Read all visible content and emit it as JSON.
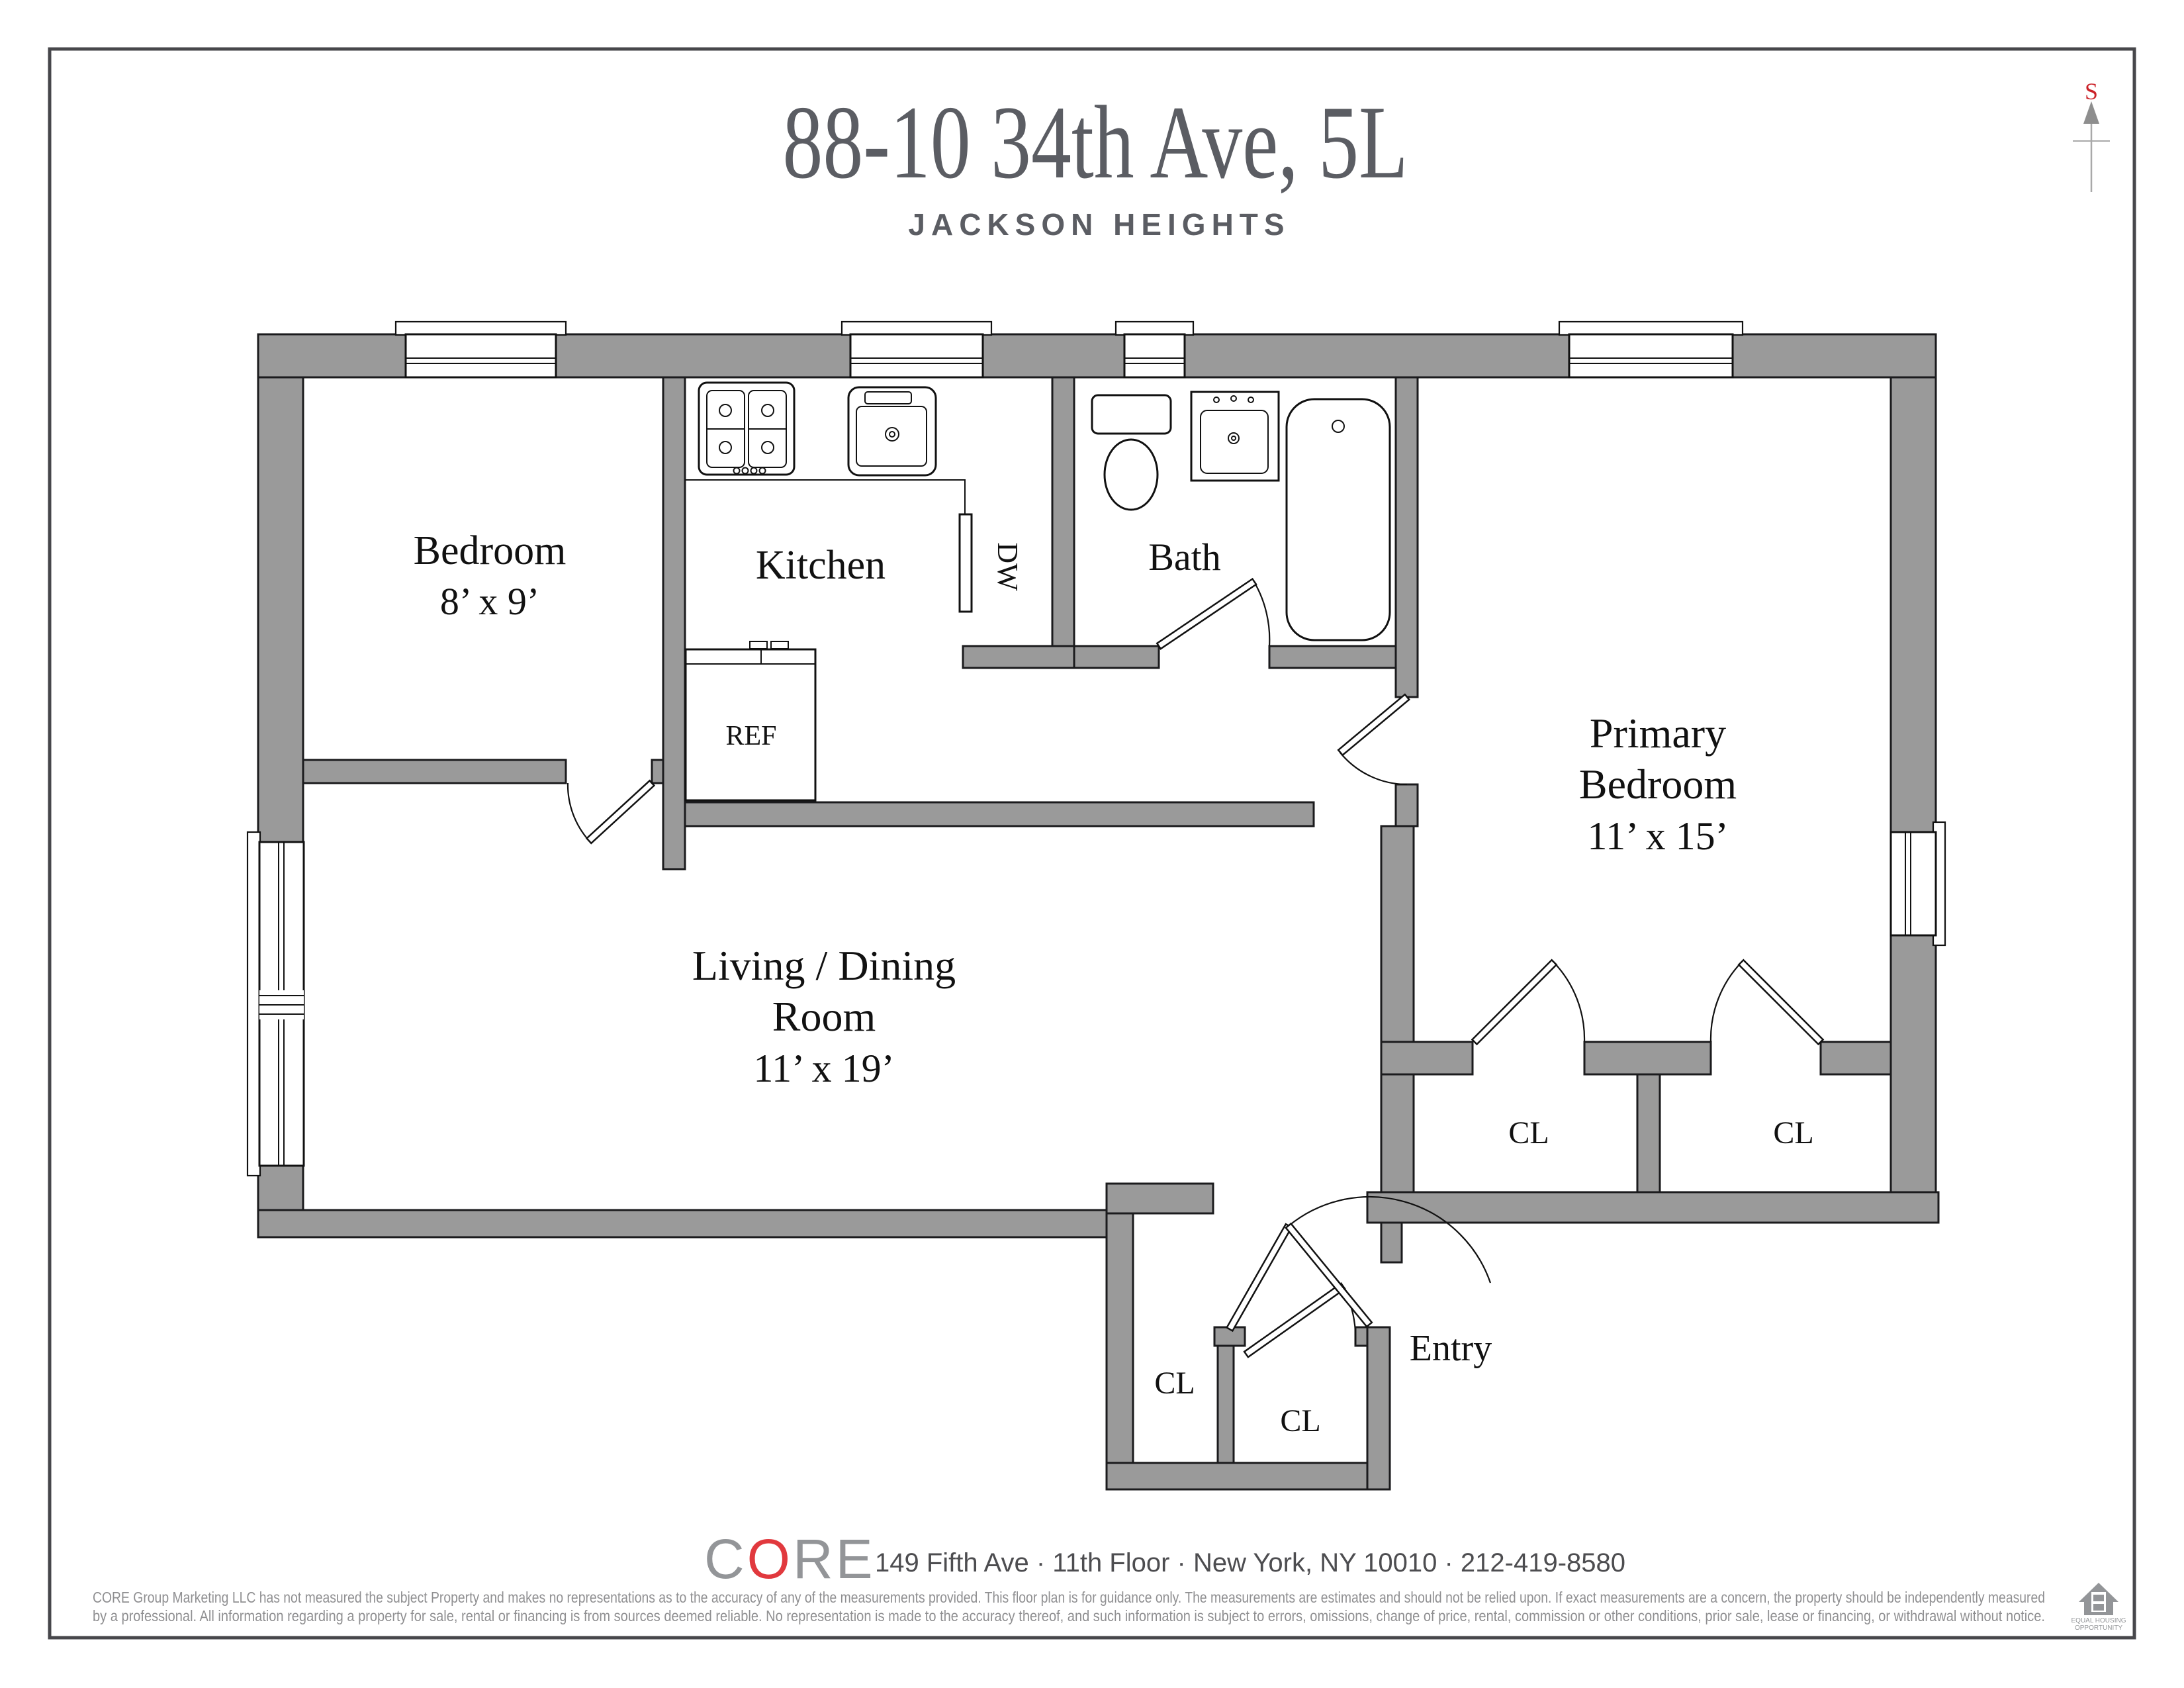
{
  "page": {
    "title": "88-10 34th Ave, 5L",
    "subtitle": "JACKSON HEIGHTS"
  },
  "compass": {
    "south_label": "S"
  },
  "plan": {
    "rooms": {
      "bedroom": {
        "name": "Bedroom",
        "dims": "8’ x 9’"
      },
      "kitchen": {
        "name": "Kitchen"
      },
      "bath": {
        "name": "Bath"
      },
      "primary_bedroom": {
        "line1": "Primary",
        "line2": "Bedroom",
        "dims": "11’ x 15’"
      },
      "living_dining": {
        "line1": "Living / Dining",
        "line2": "Room",
        "dims": "11’ x 19’"
      },
      "entry": {
        "name": "Entry"
      }
    },
    "closet_label": "CL",
    "appliances": {
      "ref": "REF",
      "dw": "DW"
    }
  },
  "footer": {
    "brand_c": "C",
    "brand_o": "O",
    "brand_re": "RE",
    "address": "149 Fifth Ave · 11th Floor · New York, NY 10010 · 212-419-8580",
    "disclaimer_line1": "CORE Group Marketing LLC has not measured the subject Property and makes no representations as to the accuracy of any of the measurements provided. This floor plan is for guidance only. The measurements are estimates and should not be relied upon. If exact measurements are a concern, the property should be independently measured",
    "disclaimer_line2": "by a professional. All information regarding a property for sale, rental or financing is from sources deemed reliable.  No representation is made to the accuracy thereof, and such information is subject to errors, omissions, change of price, rental, commission or other conditions, prior sale, lease or financing, or withdrawal without notice.",
    "equal_housing_line1": "EQUAL HOUSING",
    "equal_housing_line2": "OPPORTUNITY"
  },
  "colors": {
    "wall_gray": "#9a9a9a",
    "accent_red": "#cb2128",
    "title_gray": "#5b5d63",
    "footer_logo_gray": "#939598",
    "footer_logo_red": "#e1393e"
  }
}
